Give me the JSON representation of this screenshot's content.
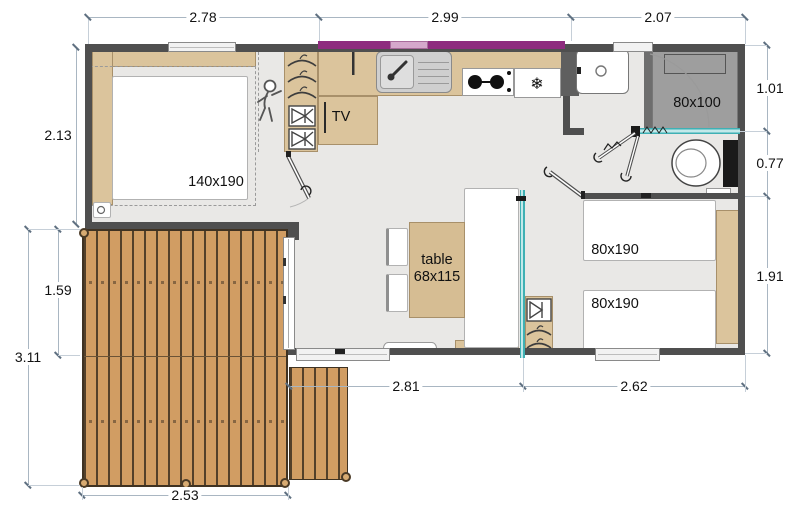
{
  "type": "mobile-home-floor-plan",
  "units": "m",
  "dimensions": {
    "top": [
      "2.78",
      "2.99",
      "2.07"
    ],
    "left": [
      "2.13",
      "1.59",
      "3.11"
    ],
    "right": [
      "1.01",
      "0.77",
      "1.91"
    ],
    "bottom": [
      "2.81",
      "2.62",
      "2.53"
    ]
  },
  "labels": {
    "master_bed": "140x190",
    "shower": "80x100",
    "tv": "TV",
    "table_line1": "table",
    "table_line2": "68x115",
    "twin_bed_1": "80x190",
    "twin_bed_2": "80x190"
  },
  "icons": {
    "fridge_snowflake": "❄"
  },
  "colors": {
    "wall": "#4f4f4f",
    "wood_furniture": "#dbc49c",
    "deck_plank": "#d19d63",
    "deck_gap": "#53402a",
    "awning_accent": "#8e2b7e",
    "glass_partition": "#45b8bb",
    "shower_tray": "#9e9e9e",
    "floor": "#e9e8e6"
  }
}
